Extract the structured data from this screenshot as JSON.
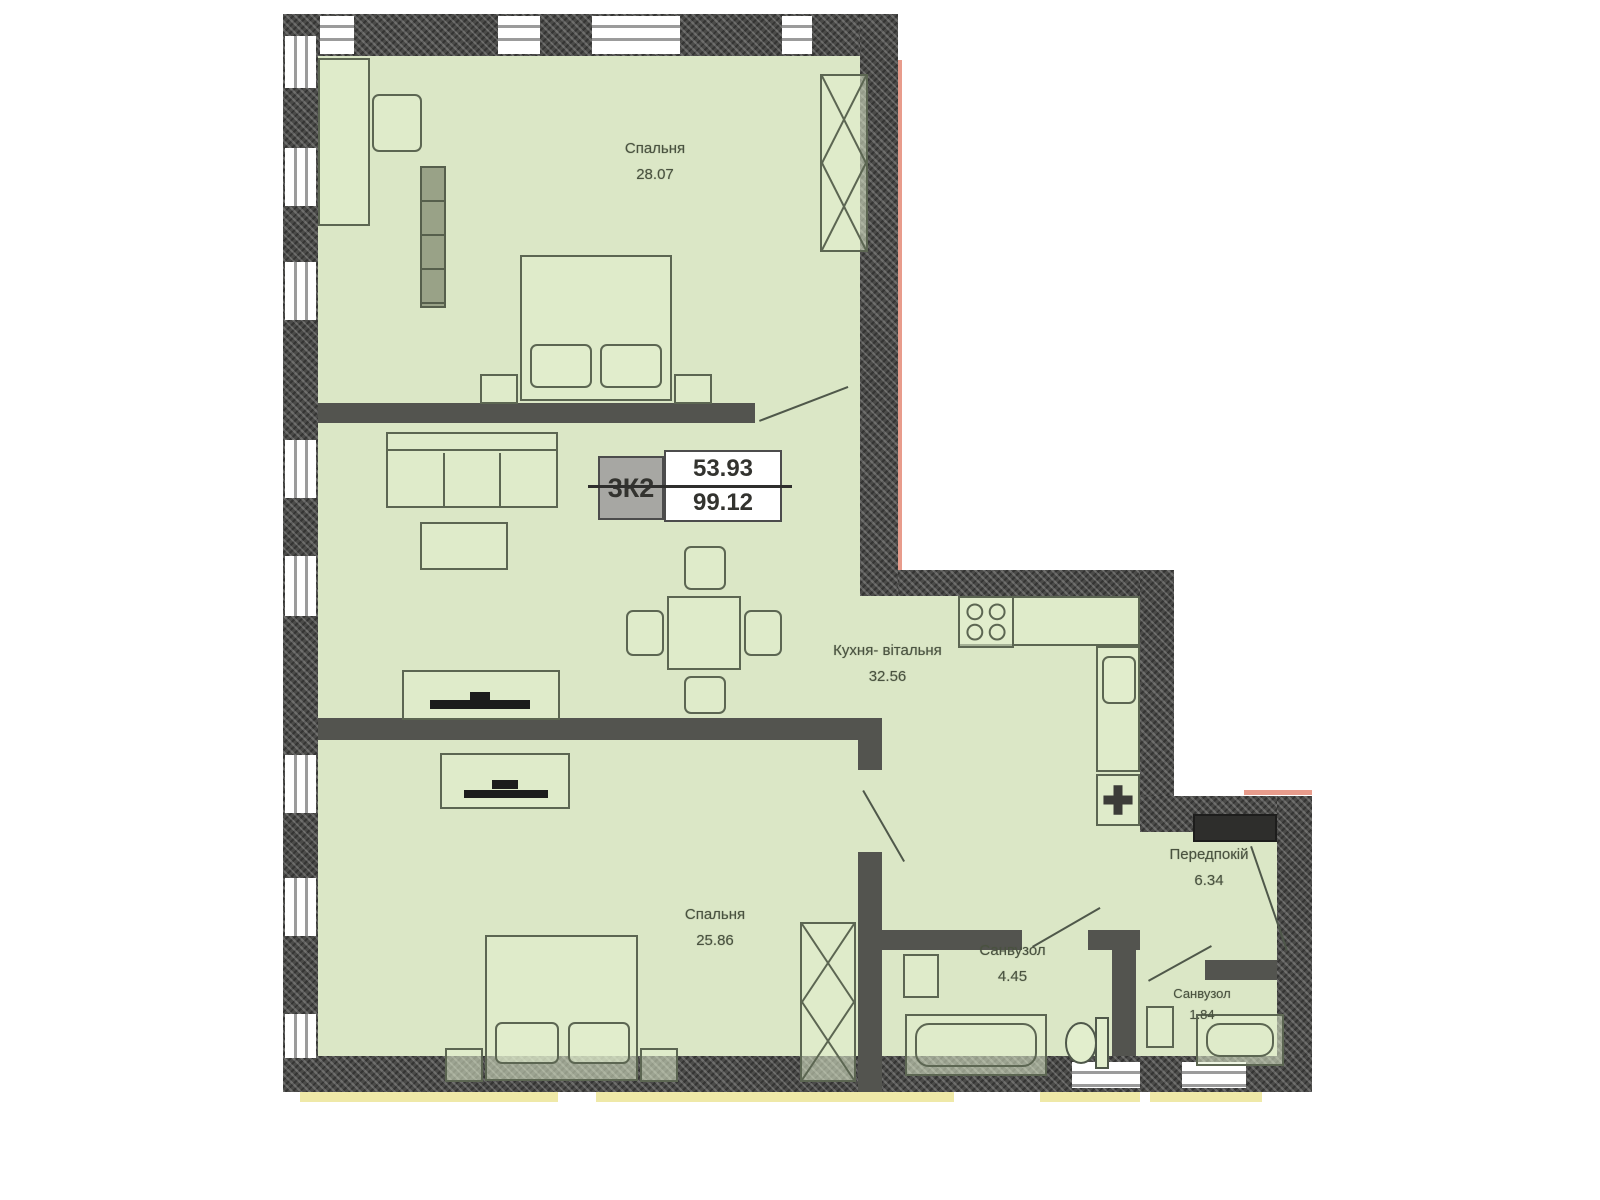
{
  "title": "Apartment floor plan",
  "plan": {
    "tag": {
      "code": "3К2",
      "area_top": "53.93",
      "area_bottom": "99.12"
    },
    "rooms": [
      {
        "name": "Спальня",
        "area": "28.07"
      },
      {
        "name": "Кухня- вітальня",
        "area": "32.56"
      },
      {
        "name": "Спальня",
        "area": "25.86"
      },
      {
        "name": "Санвузол",
        "area": "4.45"
      },
      {
        "name": "Санвузол",
        "area": "1.84"
      },
      {
        "name": "Передпокій",
        "area": "6.34"
      }
    ],
    "colors": {
      "floor": "#dbe7c6",
      "wall": "#4b4b49",
      "accent_yellow": "#efe9a8",
      "accent_salmon": "#e89c8c"
    }
  }
}
